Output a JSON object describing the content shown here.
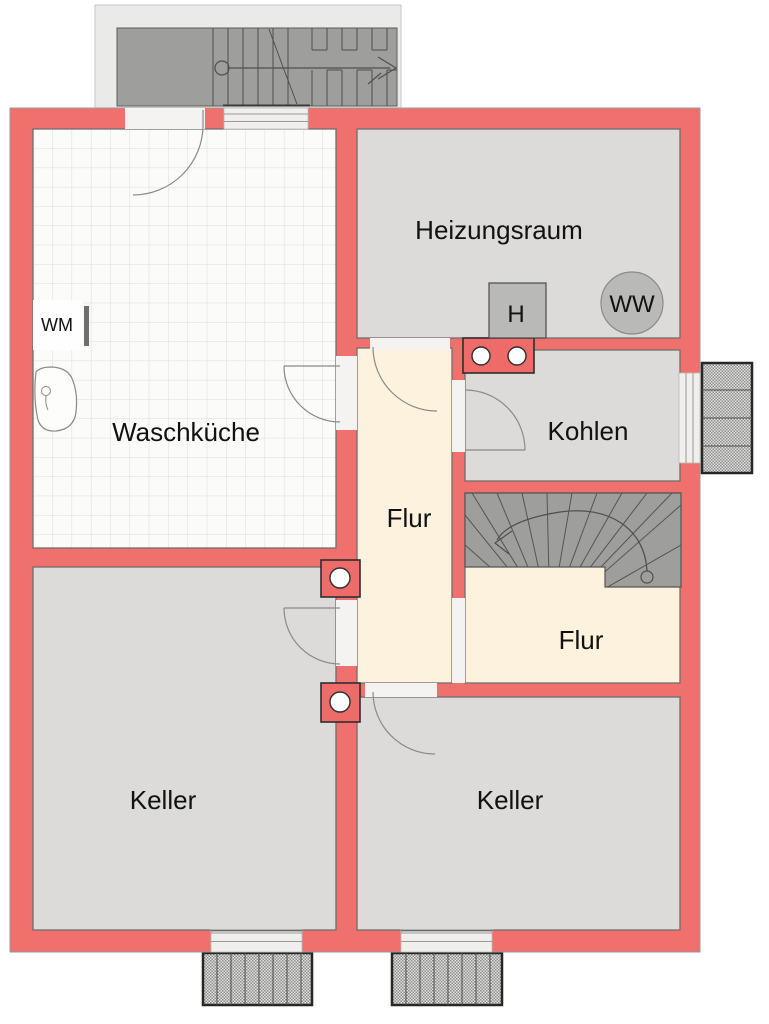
{
  "plan": {
    "title": "Kellergeschoss Grundriss",
    "rooms": {
      "waschkueche": "Waschküche",
      "heizungsraum": "Heizungsraum",
      "kohlen": "Kohlen",
      "flur_mitte": "Flur",
      "flur_treppe": "Flur",
      "keller_links": "Keller",
      "keller_rechts": "Keller"
    },
    "fixtures": {
      "waschmaschine": "WM",
      "heizung": "H",
      "warmwasser": "WW"
    },
    "colors": {
      "wall": "#f0706e",
      "floor_gray": "#dcdbd9",
      "corridor_cream": "#fcf2dd",
      "tile_white": "#fbfbfa",
      "stair_gray": "#9e9e9c"
    }
  }
}
